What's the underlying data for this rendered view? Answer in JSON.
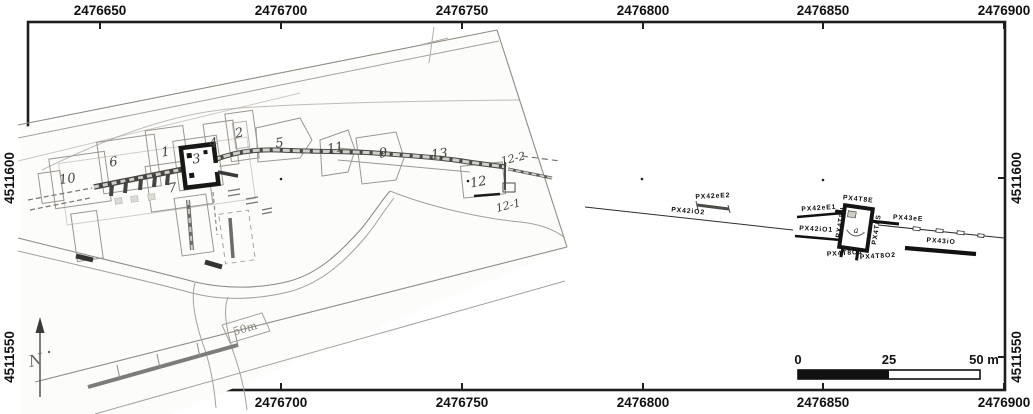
{
  "axes": {
    "x": [
      "2476650",
      "2476700",
      "2476750",
      "2476800",
      "2476850",
      "2476900"
    ],
    "y": [
      "4511600",
      "4511550"
    ]
  },
  "scalebar": {
    "t0": "0",
    "t25": "25",
    "t50": "50 m"
  },
  "scan": {
    "scale_label": "50m",
    "north_label": "N",
    "trenches": [
      "10",
      "6",
      "1",
      "3",
      "4",
      "2",
      "5",
      "7",
      "11",
      "9",
      "13",
      "12",
      "12-2",
      "12-1"
    ]
  },
  "survey": {
    "labels": [
      "PX42eE2",
      "PX42iO2",
      "PX42eE1",
      "PX42iO1",
      "PX4T8E",
      "PX4T8N",
      "PX4T8S",
      "PX4T8O1",
      "PX4T8O2",
      "PX43eE",
      "PX43iO"
    ],
    "letter": "a"
  }
}
